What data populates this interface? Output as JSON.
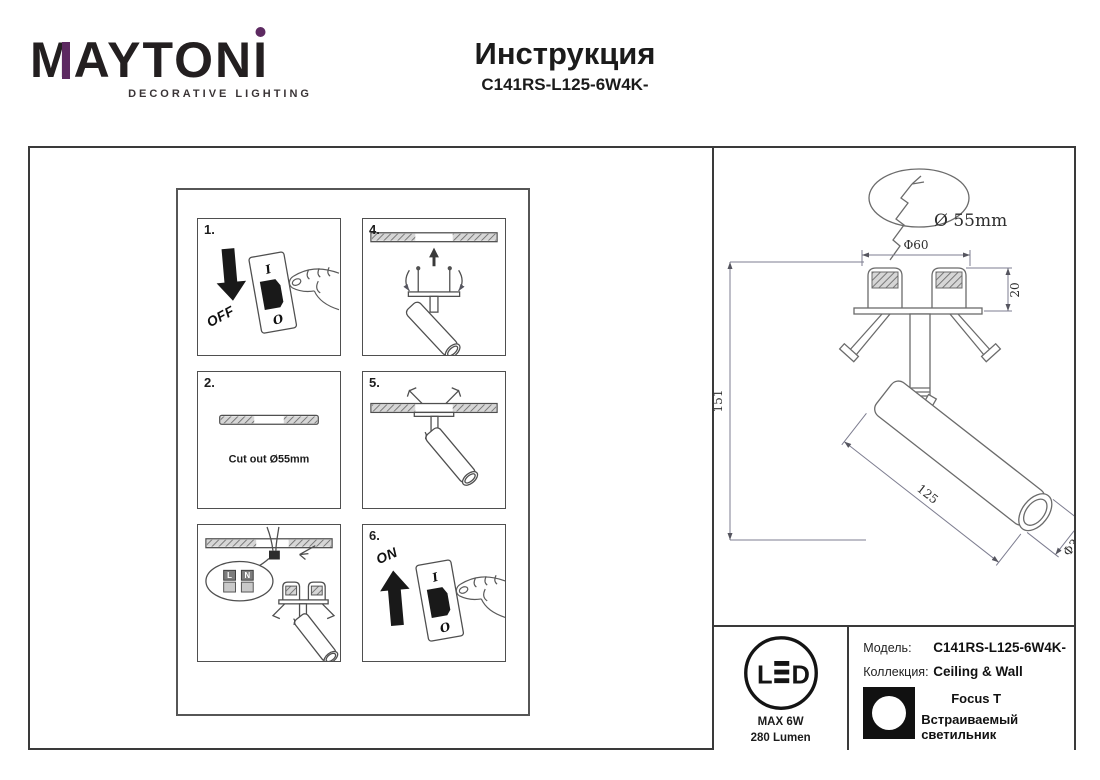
{
  "header": {
    "logo": {
      "part_m": "M",
      "part_mid": "AYTON",
      "part_i": "I",
      "tagline": "DECORATIVE LIGHTING",
      "accent_color": "#5d2a61",
      "text_color": "#231f20"
    },
    "title": "Инструкция",
    "model_code": "C141RS-L125-6W4K-"
  },
  "instructions": {
    "step1": {
      "number": "1.",
      "action": "OFF",
      "switch_top": "I",
      "switch_bottom": "O"
    },
    "step2": {
      "number": "2.",
      "caption": "Cut out Ø55mm"
    },
    "step3": {
      "terminal_left": "L",
      "terminal_right": "N"
    },
    "step4": {
      "number": "4."
    },
    "step5": {
      "number": "5."
    },
    "step6": {
      "number": "6.",
      "action": "ON",
      "switch_top": "I",
      "switch_bottom": "O"
    }
  },
  "drawing": {
    "cutout_label": "Ø 55mm",
    "top_diameter": "Φ60",
    "recess_depth": "20",
    "total_height": "151",
    "body_length": "125",
    "body_diameter": "Φ30"
  },
  "specs": {
    "led_letter_l": "L",
    "led_letter_d": "D",
    "max_power": "MAX 6W",
    "luminous_flux": "280 Lumen",
    "model_label": "Модель:",
    "model_value": "C141RS-L125-6W4K-",
    "collection_label": "Коллекция:",
    "collection_value": "Ceiling & Wall",
    "series_name": "Focus T",
    "fixture_type": "Встраиваемый светильник"
  }
}
